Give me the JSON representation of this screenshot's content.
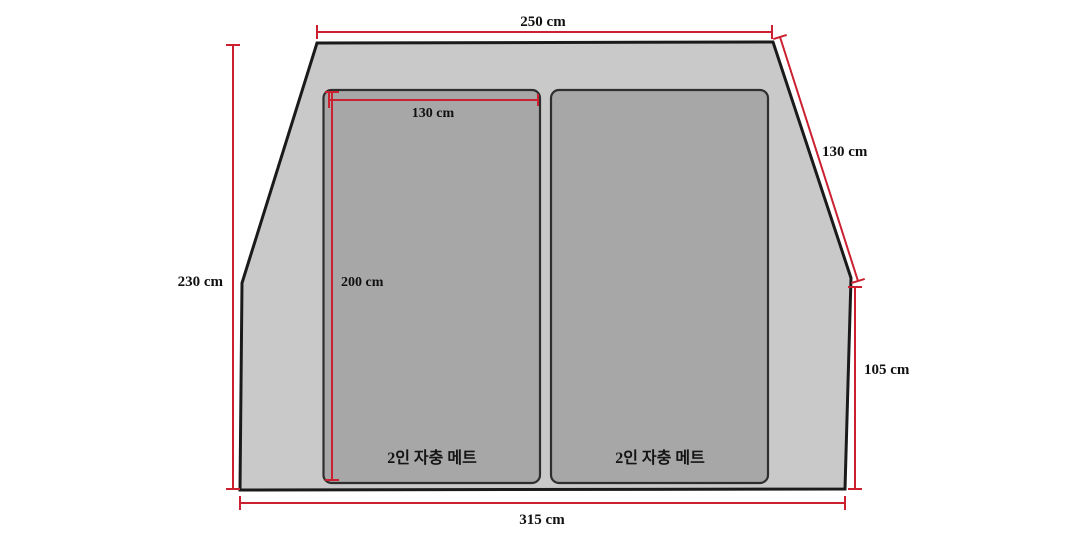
{
  "colors": {
    "dimension_red": "#cb2030",
    "tent_fill": "#c9c9c9",
    "mat_fill": "#a7a7a7",
    "outline_dark": "#1a1a1a",
    "label_text": "#111111",
    "page_bg": "#ffffff"
  },
  "dimensions": {
    "top_width": "250 cm",
    "left_height": "230 cm",
    "bottom_width": "315 cm",
    "right_slant_height": "130 cm",
    "right_side_height": "105 cm",
    "mat_width": "130 cm",
    "mat_length": "200 cm"
  },
  "mats": {
    "left_label": "2인 자충 메트",
    "right_label": "2인 자충 메트"
  }
}
